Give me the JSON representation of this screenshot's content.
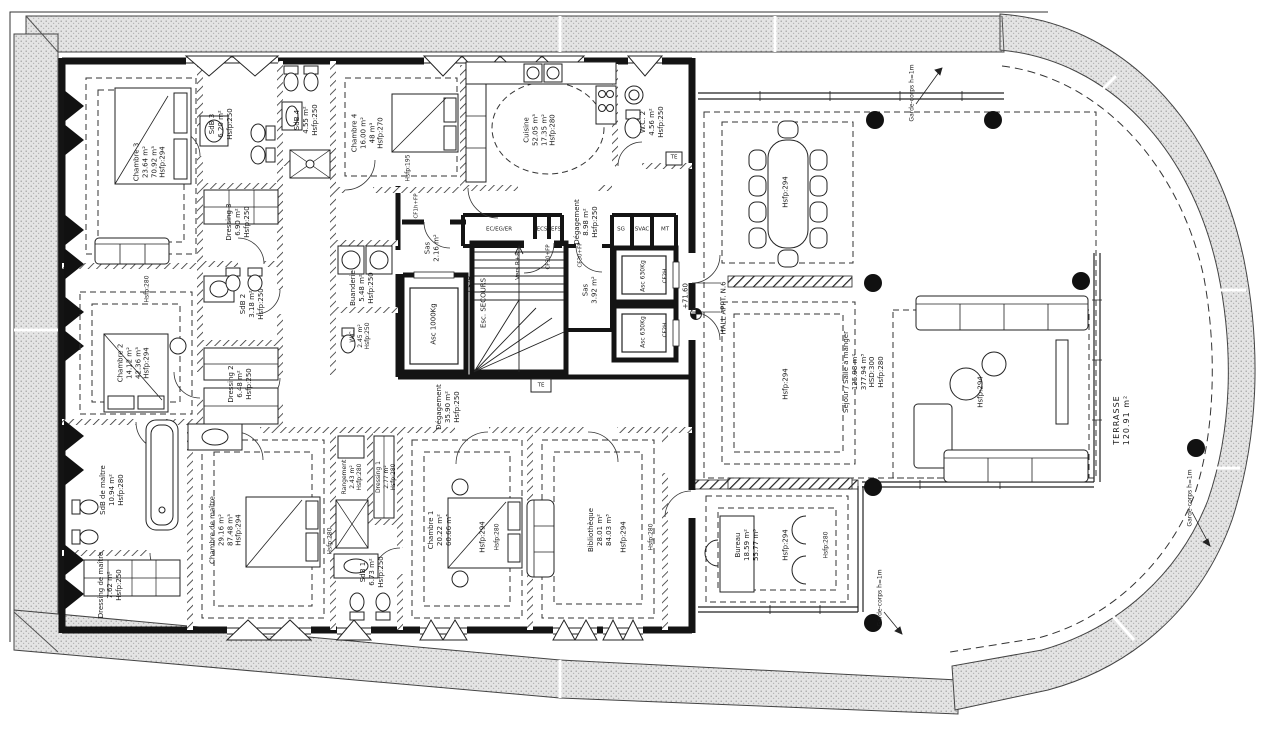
{
  "colors": {
    "ink": "#1a1a1a",
    "band_fill": "#e4e4e4",
    "paper": "#ffffff"
  },
  "rooms": {
    "chambre3": {
      "l": [
        "Chambre 3",
        "23.64 m²",
        "70.92 m³",
        "Hsfp:294"
      ]
    },
    "sdb3": {
      "l": [
        "SdB 3",
        "6.20 m²",
        "Hsfp:250"
      ]
    },
    "sdb4": {
      "l": [
        "SdB 4",
        "4.55 m²",
        "Hsfp:250"
      ]
    },
    "chambre4": {
      "l": [
        "Chambre 4",
        "16.00 m²",
        "48 m³",
        "Hsfp:270"
      ]
    },
    "cuisine": {
      "l": [
        "Cuisine",
        "52.05 m³",
        "17.35 m²",
        "Hsfp:280"
      ]
    },
    "wc2": {
      "l": [
        "W.C. 2",
        "4.56 m²",
        "Hsfp:250"
      ]
    },
    "dressing3": {
      "l": [
        "Dressing 3",
        "6.90 m²",
        "Hsfp:250"
      ]
    },
    "degagement_n": {
      "l": [
        "Dégagement",
        "8.98 m²",
        "Hsfp:250"
      ]
    },
    "buanderie": {
      "l": [
        "Buanderie",
        "5.48 m²",
        "Hsfp:250"
      ]
    },
    "wc": {
      "l": [
        "W.C.",
        "2.45 m²",
        "Hsfp:250"
      ]
    },
    "sas1": {
      "l": [
        "Sas",
        "2.16 m²"
      ]
    },
    "asc1000": {
      "l": [
        "Asc 1000Kg"
      ]
    },
    "esc": {
      "l": [
        "Esc. SECOURS"
      ]
    },
    "vers": {
      "l": [
        "Vers R+8"
      ]
    },
    "sas2": {
      "l": [
        "Sas",
        "3.92 m²"
      ]
    },
    "asc630": {
      "l": [
        "Asc 630Kg"
      ]
    },
    "hall": {
      "l": [
        "HALL APPT. N.6"
      ]
    },
    "chambre2": {
      "l": [
        "Chambre 2",
        "14.12 m²",
        "42.36 m³",
        "Hsfp:294"
      ]
    },
    "sdb2": {
      "l": [
        "SdB 2",
        "3.18 m²",
        "Hsfp:250"
      ]
    },
    "dressing2": {
      "l": [
        "Dressing 2",
        "6.48 m²",
        "Hsfp:250"
      ]
    },
    "degagement_s": {
      "l": [
        "Dégagement",
        "35.90 m²",
        "Hsfp:250"
      ]
    },
    "sdbm": {
      "l": [
        "SdB de maître",
        "10.94 m²",
        "Hsfp:280"
      ]
    },
    "dressingm": {
      "l": [
        "Dressing de maître",
        "7.62 m²",
        "Hsfp:250"
      ]
    },
    "chambrem": {
      "l": [
        "Chambre de maître",
        "29.16 m²",
        "87.48 m³",
        "Hsfp:294"
      ]
    },
    "rangement": {
      "l": [
        "Rangement",
        "2.43 m²",
        "Hsfp:280"
      ]
    },
    "dressing1": {
      "l": [
        "Dressing 1",
        "2.77 m²",
        "Hsfp:280"
      ]
    },
    "sdb1": {
      "l": [
        "SdB 1",
        "6.73 m²",
        "Hsfp:250"
      ]
    },
    "chambre1": {
      "l": [
        "Chambre 1",
        "20.22 m²",
        "60.66 m³"
      ]
    },
    "biblio": {
      "l": [
        "Bibliothèque",
        "28.01 m²",
        "84.03 m³"
      ]
    },
    "bureau": {
      "l": [
        "Bureau",
        "18.59 m²",
        "55.77 m³"
      ]
    },
    "sejour": {
      "l": [
        "Séjour / Salle à manger",
        "125.98 m²",
        "377.94 m³",
        "HSD:300",
        "Hsfp:280"
      ]
    },
    "terrasse": {
      "l": [
        "TERRASSE",
        "120.91 m²"
      ]
    }
  },
  "annotations": {
    "garde_corps": "Garde-corps h=1m",
    "level": "+71.60",
    "hsfp294": "Hsfp:294",
    "hsfp280": "Hsfp:280",
    "hsfp250": "Hsfp:250",
    "hsfp195": "Hsfp:195",
    "cf2h": "CF2H",
    "cf30": "CF30+FP",
    "cf1h": "CF1h+FP",
    "te": "TE",
    "eceger": "EC/EG/ER",
    "ecs": "ECS",
    "efs": "EFS",
    "sg": "SG",
    "svac": "SVAC",
    "mt": "MT"
  }
}
